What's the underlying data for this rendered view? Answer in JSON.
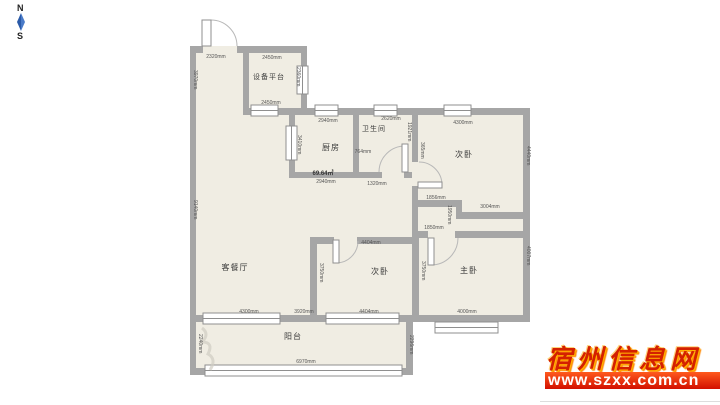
{
  "compass": {
    "north": "N",
    "south": "S"
  },
  "rooms": {
    "equipment_platform": "设备平台",
    "kitchen": "厨房",
    "bathroom": "卫生间",
    "bedroom_top": "次卧",
    "living_dining": "客餐厅",
    "bedroom_mid": "次卧",
    "master_bedroom": "主卧",
    "balcony": "阳台"
  },
  "area": "69.64㎡",
  "dims": {
    "entry_top": "2320mm",
    "platform_top": "2450mm",
    "platform_bottom": "2450mm",
    "entry_left": "3970mm",
    "platform_right": "2360mm",
    "kitchen_top": "2940mm",
    "bath_top": "2620mm",
    "bedroom2_top": "4300mm",
    "kitchen_left": "3410mm",
    "bath_right": "1921mm",
    "bath_door": "764mm",
    "hall_width": "365mm",
    "bedroom2_right": "4440mm",
    "kitchen_bottom": "2940mm",
    "hall_bottom": "1320mm",
    "bedroom2_bottom_left": "1856mm",
    "bedroom2_bottom_right": "3004mm",
    "hall_jog": "1950mm",
    "master_top": "1850mm",
    "living_left": "9140mm",
    "bedroom3_top": "4404mm",
    "bedroom3_left": "3750mm",
    "bedroom3_right": "3750mm",
    "master_right": "4007mm",
    "living_bottom": "4300mm",
    "living_bottom_right": "3920mm",
    "bedroom3_bottom": "4404mm",
    "master_bottom": "4000mm",
    "balcony_left": "2240mm",
    "balcony_right": "2296mm",
    "balcony_bottom": "6970mm"
  },
  "watermark": {
    "site_name": "宿州信息网",
    "site_url": "www.szxx.com.cn"
  },
  "colors": {
    "wall": "#a6a6a6",
    "floor": "#f0ede3",
    "watermark_red": "#d42000",
    "watermark_gold": "#ffb300",
    "compass_blue": "#3a6fc8"
  }
}
